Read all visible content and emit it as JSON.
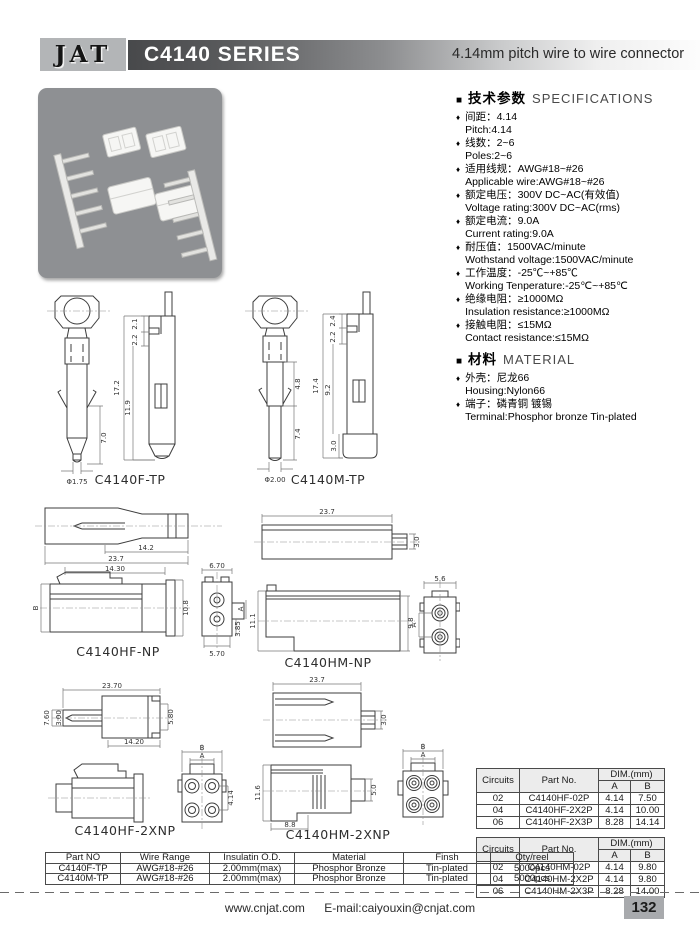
{
  "icons": {
    "square": "■",
    "diamond": "♦"
  },
  "colors": {
    "header_bar_dark": "#48494b",
    "logo_bg": "#b3b5b7",
    "photo_bg": "#8e9093",
    "table_header_bg": "#ececec",
    "page_box_bg": "#a8aaad"
  },
  "header": {
    "logo": "JAT",
    "series_title": "C4140 SERIES",
    "tagline": "4.14mm pitch  wire to wire connector"
  },
  "specs": {
    "title_cn": "技术参数",
    "title_en": "SPECIFICATIONS",
    "items": [
      {
        "cn": "间距：4.14",
        "en": "Pitch:4.14"
      },
      {
        "cn": "线数：2~6",
        "en": "Poles:2~6"
      },
      {
        "cn": "适用线规：AWG#18~#26",
        "en": "Applicable wire:AWG#18~#26"
      },
      {
        "cn": "额定电压：300V DC~AC(有效值)",
        "en": "Voltage rating:300V DC~AC(rms)"
      },
      {
        "cn": "额定电流：9.0A",
        "en": "Current rating:9.0A"
      },
      {
        "cn": "耐压值：1500VAC/minute",
        "en": "Wothstand voltage:1500VAC/minute"
      },
      {
        "cn": "工作温度：-25℃~+85℃",
        "en": "Working Tenperature:-25℃~+85℃"
      },
      {
        "cn": "绝缘电阻：≥1000MΩ",
        "en": "Insulation resistance:≥1000MΩ"
      },
      {
        "cn": "接触电阻：≤15MΩ",
        "en": "Contact resistance:≤15MΩ"
      }
    ]
  },
  "material": {
    "title_cn": "材料",
    "title_en": "MATERIAL",
    "items": [
      {
        "cn": "外壳：尼龙66",
        "en": "Housing:Nylon66"
      },
      {
        "cn": "端子：磷青铜 镀锡",
        "en": "Terminal:Phosphor bronze Tin-plated"
      }
    ]
  },
  "drawings": {
    "f_tp": {
      "label": "C4140F-TP",
      "d21": "2.1",
      "d22": "2.2",
      "d172": "17.2",
      "d119": "11.9",
      "d70": "7.0",
      "dphi": "Φ1.75"
    },
    "m_tp": {
      "label": "C4140M-TP",
      "d24": "2.4",
      "d22": "2.2",
      "d174": "17.4",
      "d92": "9.2",
      "d48": "4.8",
      "d74": "7.4",
      "d30": "3.0",
      "dphi": "Φ2.00"
    },
    "hf_np": {
      "label": "C4140HF-NP",
      "d142": "14.2",
      "d237": "23.7",
      "d1430": "14.30",
      "dB": "B",
      "d108": "10.8",
      "d670": "6.70",
      "d570": "5.70",
      "d385": "3.85",
      "dA": "A"
    },
    "hm_np": {
      "label": "C4140HM-NP",
      "d237": "23.7",
      "d30": "3.0",
      "d111": "11.1",
      "d98": "9.8",
      "d56": "5.6",
      "dA": "A"
    },
    "hf_2xnp": {
      "label": "C4140HF-2XNP",
      "d2370": "23.70",
      "d760": "7.60",
      "d300": "3.00",
      "d580": "5.80",
      "d1420": "14.20",
      "dB": "B",
      "dA": "A",
      "d414": "4.14"
    },
    "hm_2xnp": {
      "label": "C4140HM-2XNP",
      "d237": "23.7",
      "d30": "3.0",
      "d116": "11.6",
      "d88": "8.8",
      "d50": "5.0",
      "dB": "B",
      "dA": "A"
    }
  },
  "tables": {
    "hf": {
      "circuits_label": "Circuits",
      "part_label": "Part No.",
      "dim_label": "DIM.(mm)",
      "a_label": "A",
      "b_label": "B",
      "rows": [
        [
          "02",
          "C4140HF-02P",
          "4.14",
          "7.50"
        ],
        [
          "04",
          "C4140HF-2X2P",
          "4.14",
          "10.00"
        ],
        [
          "06",
          "C4140HF-2X3P",
          "8.28",
          "14.14"
        ]
      ]
    },
    "hm": {
      "circuits_label": "Circuits",
      "part_label": "Part No.",
      "dim_label": "DIM.(mm)",
      "a_label": "A",
      "b_label": "B",
      "rows": [
        [
          "02",
          "C4140HM-02P",
          "4.14",
          "9.80"
        ],
        [
          "04",
          "C4140HM-2X2P",
          "4.14",
          "9.80"
        ],
        [
          "06",
          "C4140HM-2X3P",
          "8.28",
          "14.00"
        ]
      ]
    },
    "terminal": {
      "headers": [
        "Part NO",
        "Wire Range",
        "Insulatin O.D.",
        "Material",
        "Finsh",
        "Qty/reel"
      ],
      "rows": [
        [
          "C4140F-TP",
          "AWG#18-#26",
          "2.00mm(max)",
          "Phosphor Bronze",
          "Tin-plated",
          "5000pcs"
        ],
        [
          "C4140M-TP",
          "AWG#18-#26",
          "2.00mm(max)",
          "Phosphor Bronze",
          "Tin-plated",
          "5000pcs"
        ]
      ]
    }
  },
  "footer": {
    "website": "www.cnjat.com",
    "email": "E-mail:caiyouxin@cnjat.com",
    "page_number": "132"
  }
}
